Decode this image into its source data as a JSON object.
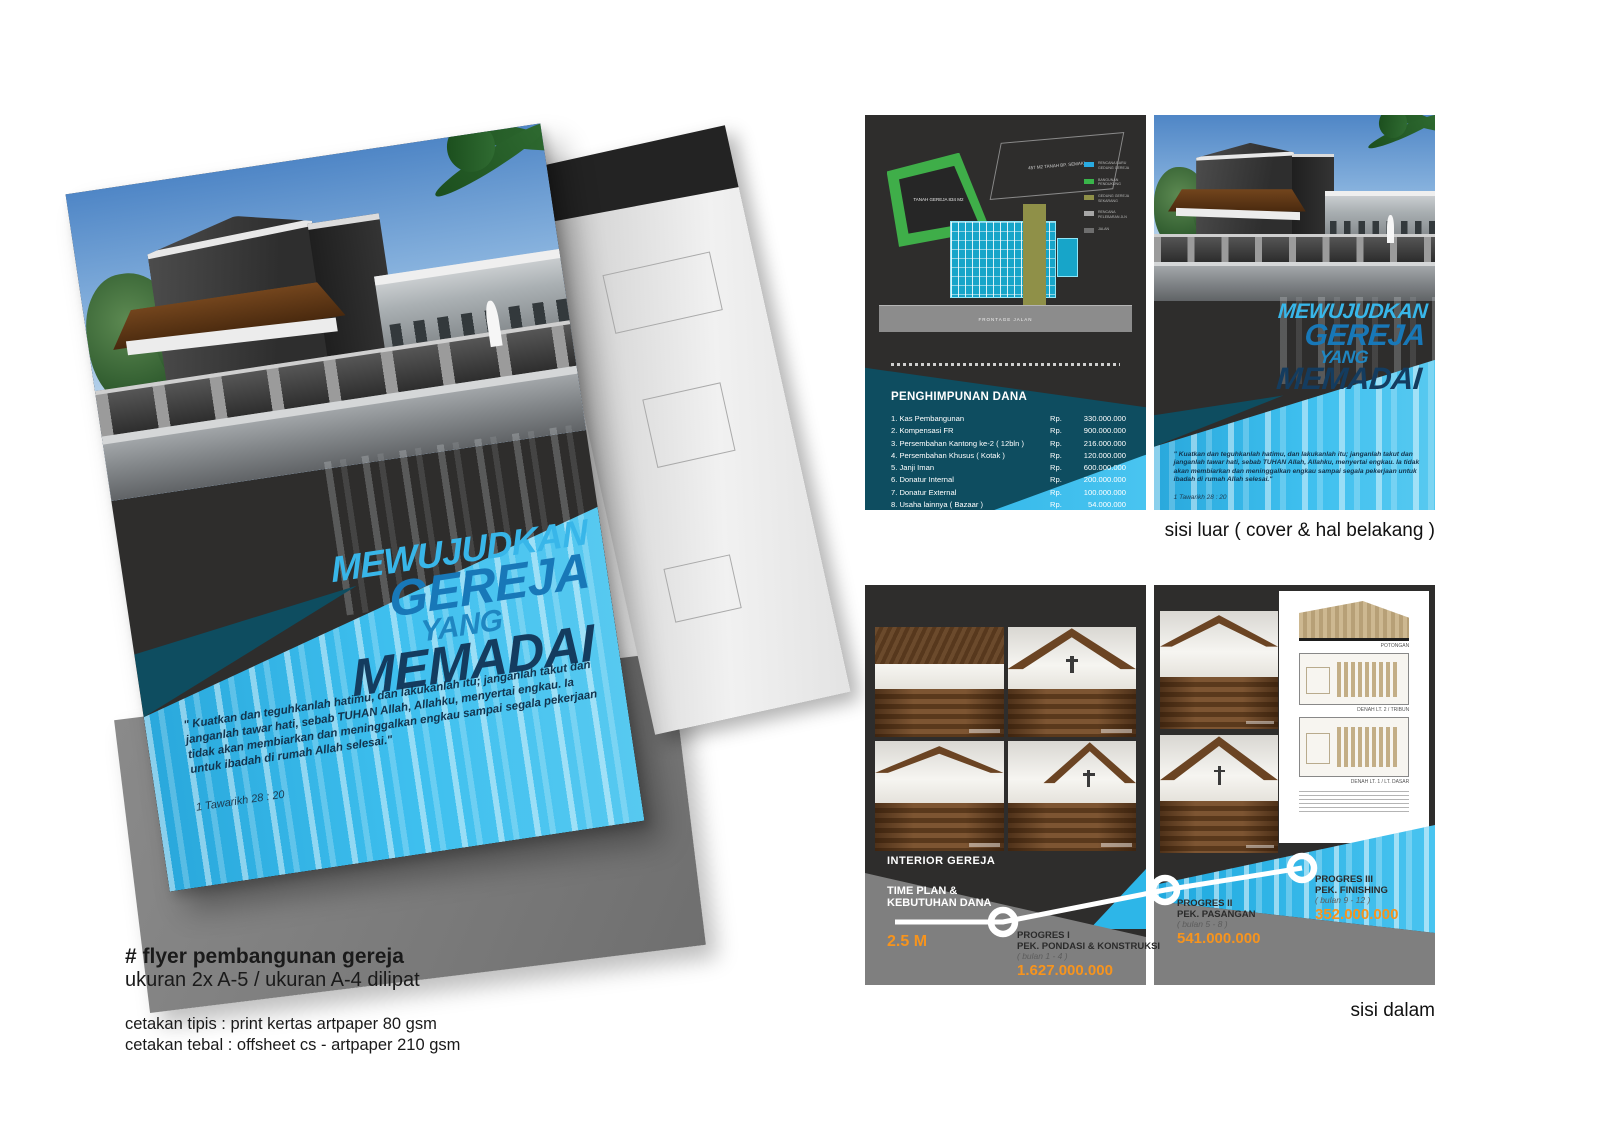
{
  "captions": {
    "outer": "sisi luar ( cover & hal belakang )",
    "inner": "sisi dalam"
  },
  "annotation": {
    "title": "# flyer pembangunan gereja",
    "size_line": "ukuran 2x A-5 / ukuran A-4 dilipat",
    "print_line1": "cetakan tipis : print kertas artpaper 80 gsm",
    "print_line2": "cetakan tebal : offsheet cs - artpaper 210 gsm"
  },
  "cover": {
    "title_line1": "MEWUJUDKAN",
    "title_line2": "GEREJA",
    "title_line3": "YANG",
    "title_line4": "MEMADAI",
    "quote": "\" Kuatkan dan teguhkanlah hatimu, dan lakukanlah itu; janganlah takut dan janganlah tawar hati, sebab TUHAN Allah, Allahku, menyertai engkau. Ia tidak akan membiarkan dan meninggalkan engkau sampai segala pekerjaan untuk ibadah di rumah Allah selesai.\"",
    "reference": "1 Tawarikh 28 : 20"
  },
  "back_page": {
    "site_plan": {
      "lot1_label": "TANAH GEREJA 834 M2",
      "lot2_label": "457 M2 TANAH BP. SEMAKI",
      "road_label": "FRONTAGE JALAN",
      "legend": [
        {
          "color": "#29ABE2",
          "label": "RENCANA BARU GEDUNG GEREJA"
        },
        {
          "color": "#39B54A",
          "label": "BANGUNAN PENDUKUNG"
        },
        {
          "color": "#8F9048",
          "label": "GEDUNG GEREJA SEKARANG"
        },
        {
          "color": "#A7A7A7",
          "label": "RENCANA PELEBARAN JLN"
        },
        {
          "color": "#6E6E6E",
          "label": "JALAN"
        }
      ]
    },
    "funding": {
      "heading": "PENGHIMPUNAN DANA",
      "currency": "Rp.",
      "items": [
        {
          "name": "1. Kas Pembangunan",
          "amount": "330.000.000"
        },
        {
          "name": "2. Kompensasi FR",
          "amount": "900.000.000"
        },
        {
          "name": "3. Persembahan Kantong ke-2 ( 12bln )",
          "amount": "216.000.000"
        },
        {
          "name": "4. Persembahan Khusus ( Kotak )",
          "amount": "120.000.000"
        },
        {
          "name": "5. Janji Iman",
          "amount": "600.000.000"
        },
        {
          "name": "6. Donatur Internal",
          "amount": "200.000.000"
        },
        {
          "name": "7. Donatur External",
          "amount": "100.000.000"
        },
        {
          "name": "8. Usaha lainnya ( Bazaar )",
          "amount": "54.000.000"
        }
      ],
      "total": "Rp. 2.520.000.000"
    }
  },
  "inner_pages": {
    "interior_label": "INTERIOR GEREJA",
    "drawings": [
      {
        "label": "POTONGAN"
      },
      {
        "label": "DENAH LT. 2 / TRIBUN"
      },
      {
        "label": "DENAH LT. 1 / LT. DASAR"
      }
    ],
    "timeline": {
      "heading_line1": "TIME PLAN &",
      "heading_line2": "KEBUTUHAN DANA",
      "total": "2.5 M",
      "milestones": [
        {
          "name": "PROGRES I",
          "work": "PEK. PONDASI & KONSTRUKSI",
          "period": "( bulan 1 - 4 )",
          "amount": "1.627.000.000"
        },
        {
          "name": "PROGRES II",
          "work": "PEK. PASANGAN",
          "period": "( bulan 5 - 8 )",
          "amount": "541.000.000"
        },
        {
          "name": "PROGRES III",
          "work": "PEK. FINISHING",
          "period": "( bulan 9 - 12 )",
          "amount": "352.000.000"
        }
      ]
    }
  },
  "colors": {
    "accent_cyan": "#29ABE2",
    "accent_orange": "#F7941D",
    "charcoal": "#2E2D2C",
    "teal_dark": "#0E4D60",
    "navy_title": "#143C5F",
    "timeline_gray": "#7F7F7F"
  }
}
